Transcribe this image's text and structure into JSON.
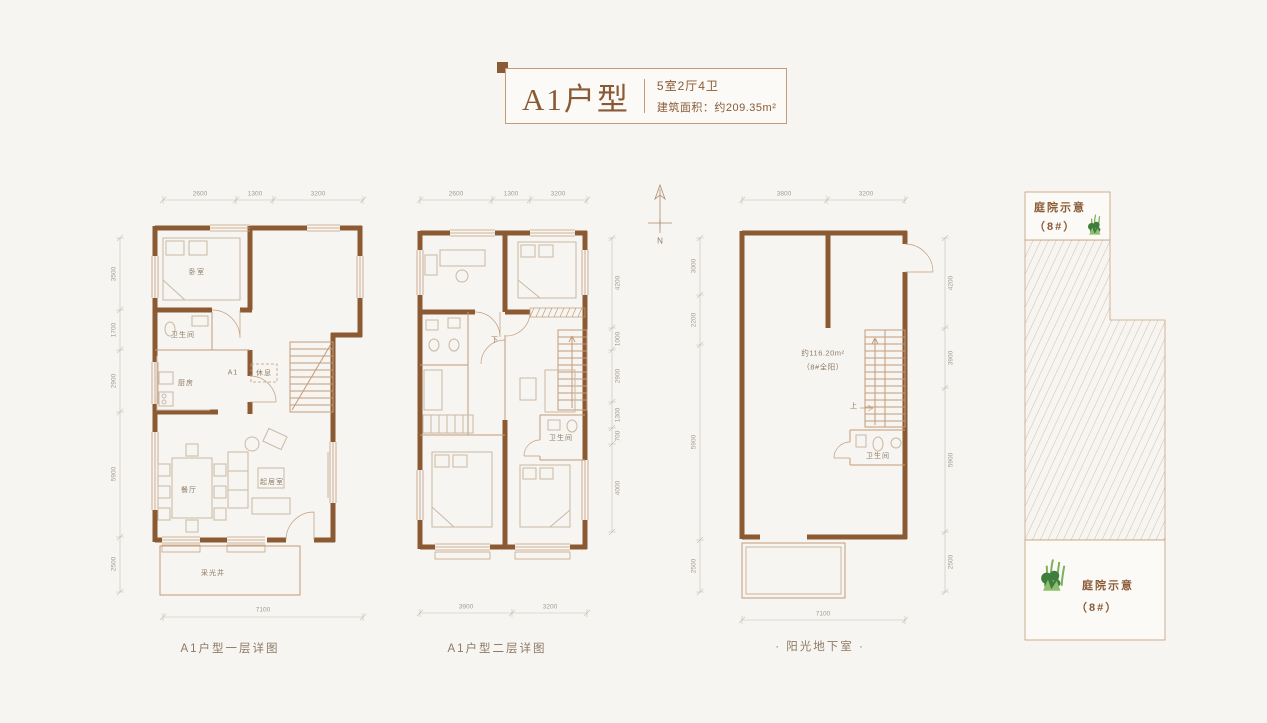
{
  "title_block": {
    "name": "A1户型",
    "spec": "5室2厅4卫",
    "area": "建筑面积：约209.35m²"
  },
  "compass": {
    "label": "N"
  },
  "plans": [
    {
      "caption": "A1户型一层详图",
      "rooms": {
        "bedroom": "卧室",
        "bath": "卫生间",
        "kitchen": "厨房",
        "unit": "A1",
        "rest": "休息",
        "dining": "餐厅",
        "living": "起居室",
        "lightwell": "采光井"
      },
      "dims_top": [
        "2600",
        "1300",
        "3200"
      ],
      "dims_left": [
        "3500",
        "1700",
        "2900",
        "5900",
        "2500"
      ],
      "dims_bottom": [
        "7100"
      ]
    },
    {
      "caption": "A1户型二层详图",
      "rooms": {
        "down": "下",
        "bath": "卫生间"
      },
      "dims_top": [
        "2600",
        "1300",
        "3200"
      ],
      "dims_right": [
        "4200",
        "1000",
        "2900",
        "1300",
        "700",
        "4000"
      ],
      "dims_bottom": [
        "3900",
        "3200"
      ]
    },
    {
      "caption": "· 阳光地下室 ·",
      "area_note_line1": "约116.20m²",
      "area_note_line2": "（8#全阳）",
      "rooms": {
        "up": "上",
        "bath": "卫生间"
      },
      "dims_top": [
        "3800",
        "3200"
      ],
      "dims_left": [
        "3000",
        "2200",
        "5900",
        "2500"
      ],
      "dims_right": [
        "4200",
        "3900",
        "5900",
        "2500"
      ],
      "dims_bottom": [
        "7100"
      ]
    }
  ],
  "courtyard": {
    "top": {
      "line1": "庭院示意",
      "line2": "（8#）"
    },
    "bottom": {
      "line1": "庭院示意",
      "line2": "（8#）"
    }
  },
  "colors": {
    "background": "#f6f5f2",
    "wall": "#8b5a33",
    "line": "#c49c78",
    "furniture": "#ccb8a2",
    "accent_text": "#8a5a36",
    "dim_text": "#a39d94",
    "label_text": "#8f7a64",
    "plant_dark": "#3e7d3c",
    "plant_light": "#7fae5f",
    "hatch": "#c9a584"
  }
}
